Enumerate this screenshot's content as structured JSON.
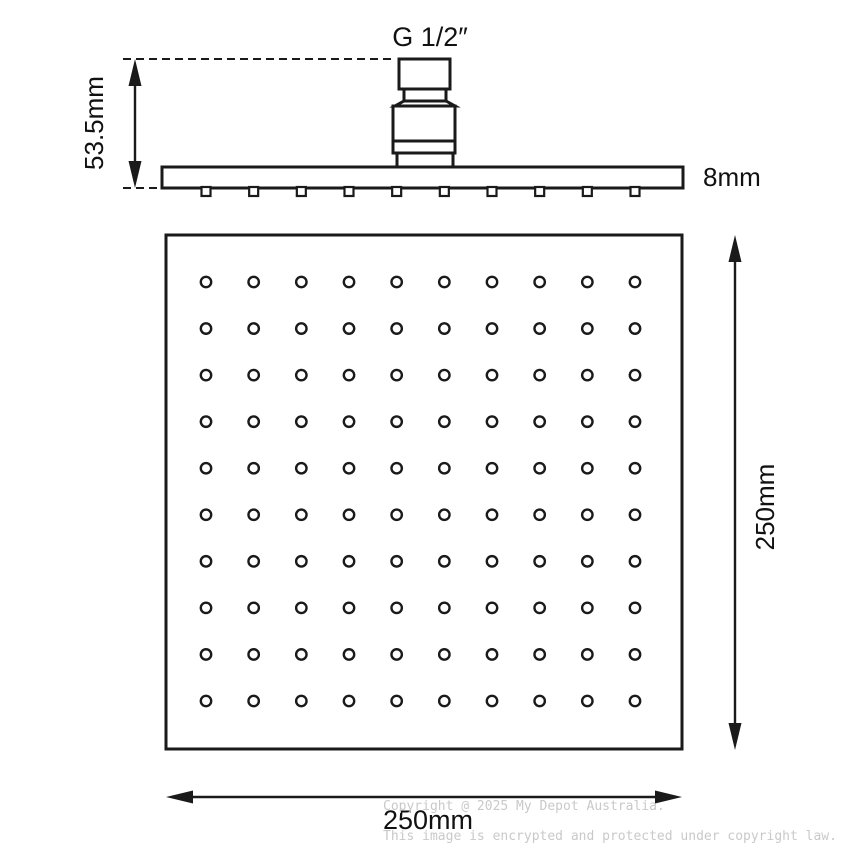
{
  "diagram": {
    "product": "square-rain-shower-head-technical-drawing",
    "labels": {
      "thread_size": "G 1/2″",
      "head_height": "53.5mm",
      "plate_thickness": "8mm",
      "plate_width": "250mm",
      "plate_depth": "250mm"
    },
    "spray_grid": {
      "rows": 10,
      "cols": 10
    },
    "nozzle_count": 10,
    "colors": {
      "line": "#1a1a1a",
      "watermark": "#c9c9c9",
      "background": "#ffffff"
    },
    "watermark": {
      "line1": "Copyright @ 2025 My Depot Australia.",
      "line2": "This image is encrypted and protected under copyright law."
    }
  }
}
